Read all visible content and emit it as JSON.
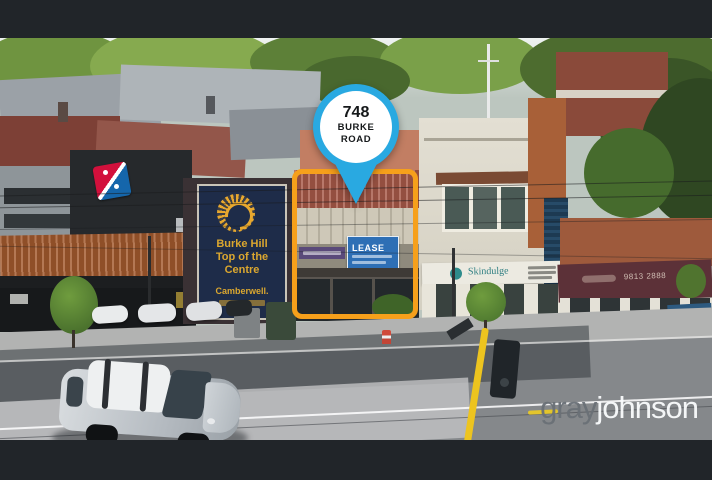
{
  "window": {
    "letterbox_color": "#212529"
  },
  "photo": {
    "description": "aerial-street-photo-of-shops",
    "pin": {
      "number": "748",
      "road1": "BURKE",
      "road2": "ROAD",
      "color": "#29A9E1"
    },
    "highlight": {
      "color": "#F6A01B"
    },
    "signs": {
      "lease": "LEASE",
      "burke_hill": {
        "l1": "Burke Hill",
        "l2": "Top of the",
        "l3": "Centre",
        "l4": "Camberwell."
      },
      "skindulge": "Skindulge",
      "awning_phone": "9813 2888"
    },
    "watermark": {
      "gray": "gray",
      "johnson": "johnson"
    }
  }
}
